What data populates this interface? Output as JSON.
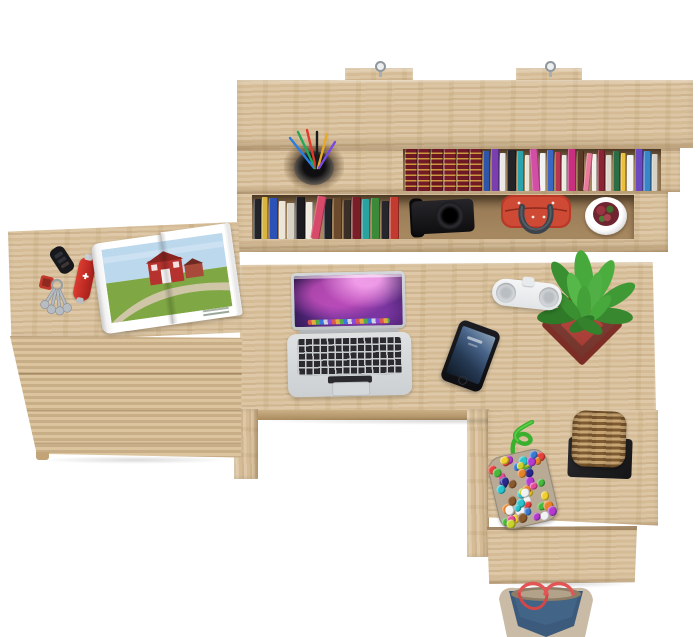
{
  "meta": {
    "description": "Top-down product photo of a light oak home-office set: wall hutch with books, L-shaped desk with laptop, phone, speaker and plant, three-drawer cabinet with keys, pocket knife and open magazine, desk return with bead pouch, wicker basket, drawer unit and a denim tote bag on the floor."
  },
  "palette": {
    "bg": "#ffffff",
    "wood": "#d8bf98",
    "woodLight": "#e3cda8",
    "woodDark": "#c3a478",
    "shelfBack": "#b1926a",
    "cordGreen": "#3ab02e",
    "bagRed": "#c5402f",
    "handleGray": "#3d434a",
    "basketTan": "#a87f4c",
    "denimBlue": "#3c5a7c",
    "denimTan": "#c9bba6",
    "strapRed": "#e25555",
    "plantGreen": "#3f9a35",
    "potRed": "#b5453c"
  },
  "shelf": {
    "upper_books": [
      {
        "c": "#6e1825",
        "w": 12,
        "h": 42,
        "g": 1
      },
      {
        "c": "#731a27",
        "w": 12,
        "h": 42,
        "g": 1
      },
      {
        "c": "#6a1622",
        "w": 12,
        "h": 42,
        "g": 1
      },
      {
        "c": "#771b28",
        "w": 12,
        "h": 42,
        "g": 1
      },
      {
        "c": "#6e1825",
        "w": 12,
        "h": 42,
        "g": 1
      },
      {
        "c": "#731a27",
        "w": 12,
        "h": 42,
        "g": 1
      },
      {
        "c": "#2e55aa",
        "w": 7,
        "h": 40
      },
      {
        "c": "#7a3fae",
        "w": 8,
        "h": 42
      },
      {
        "c": "#e9e9e9",
        "w": 6,
        "h": 38
      },
      {
        "c": "#23242a",
        "w": 9,
        "h": 41
      },
      {
        "c": "#2aa3ad",
        "w": 7,
        "h": 40
      },
      {
        "c": "#e8e4da",
        "w": 5,
        "h": 36
      },
      {
        "c": "#d34fa5",
        "w": 8,
        "h": 42,
        "l": -4
      },
      {
        "c": "#f2f2f2",
        "w": 6,
        "h": 38
      },
      {
        "c": "#3a66c4",
        "w": 7,
        "h": 41
      },
      {
        "c": "#b8374e",
        "w": 6,
        "h": 39
      },
      {
        "c": "#efeae0",
        "w": 5,
        "h": 36
      },
      {
        "c": "#c92f7f",
        "w": 8,
        "h": 42
      },
      {
        "c": "#5a3a28",
        "w": 7,
        "h": 40
      },
      {
        "c": "#e87a9a",
        "w": 6,
        "h": 38,
        "l": 6
      },
      {
        "c": "#f5f0e6",
        "w": 5,
        "h": 37
      },
      {
        "c": "#8a2433",
        "w": 7,
        "h": 41
      },
      {
        "c": "#ddd8cc",
        "w": 6,
        "h": 36
      },
      {
        "c": "#2a6e46",
        "w": 7,
        "h": 40
      },
      {
        "c": "#e8c23a",
        "w": 5,
        "h": 38
      },
      {
        "c": "#f4f4f4",
        "w": 7,
        "h": 36
      },
      {
        "c": "#6a49c0",
        "w": 8,
        "h": 42
      },
      {
        "c": "#3a85c8",
        "w": 7,
        "h": 40
      },
      {
        "c": "#d6d2c8",
        "w": 6,
        "h": 37
      }
    ],
    "lower_books": [
      {
        "c": "#23242a",
        "w": 7,
        "h": 40
      },
      {
        "c": "#d8b440",
        "w": 6,
        "h": 42
      },
      {
        "c": "#2a52b8",
        "w": 9,
        "h": 41
      },
      {
        "c": "#ece6da",
        "w": 7,
        "h": 38
      },
      {
        "c": "#d8d2c4",
        "w": 8,
        "h": 36
      },
      {
        "c": "#1c1c20",
        "w": 9,
        "h": 42
      },
      {
        "c": "#f0ece0",
        "w": 7,
        "h": 37
      },
      {
        "c": "#d84a6a",
        "w": 9,
        "h": 43,
        "l": 10
      },
      {
        "c": "#20222a",
        "w": 8,
        "h": 40
      },
      {
        "c": "#6b4a2e",
        "w": 9,
        "h": 41
      },
      {
        "c": "#3a2e26",
        "w": 8,
        "h": 39
      },
      {
        "c": "#7a1f28",
        "w": 9,
        "h": 42
      },
      {
        "c": "#2aa3a0",
        "w": 8,
        "h": 40
      },
      {
        "c": "#3a8a3a",
        "w": 9,
        "h": 41
      },
      {
        "c": "#26262c",
        "w": 8,
        "h": 38
      },
      {
        "c": "#c23b2e",
        "w": 9,
        "h": 42
      }
    ]
  },
  "beads": {
    "colors": [
      "#e8413c",
      "#f2cf2c",
      "#3a7ad4",
      "#47b83c",
      "#e8822a",
      "#b43ad0",
      "#2ac4cf",
      "#f2f2f2",
      "#e84a9a",
      "#8a5a2e",
      "#2a2a8e",
      "#c9d42a"
    ],
    "count": 56,
    "size": 7
  },
  "objects": {
    "hutch": "oak wall shelf with two metal hanging brackets",
    "pen_cup": "black cup holding coloured pens",
    "encyclopedia_set": "dark red hardcover set with gold bands",
    "camera": "black camera",
    "red_handbag": "red handbag with dark grey handles",
    "white_flowerpot": "white pot with burgundy plant",
    "laptop": "silver laptop, purple galaxy wallpaper, black keys",
    "speaker": "white pill-shaped portable speaker",
    "smartphone": "black smartphone with blue lock screen",
    "potted_plant": "green speckled plant in red square pot",
    "car_keys": "black car fob, red keychain and key bundle",
    "pocket_knife": "red pocket knife with white cross",
    "magazine": "open magazine spread showing a red barn in a green field",
    "drawer_cabinet": "oak cabinet with three drawers",
    "bead_pouch": "multicolour bead pouch with green cord",
    "wicker_basket": "woven rope basket on black square base",
    "return_drawer": "oak drawer unit under the desk return",
    "denim_bag": "blue denim tote with tan trim and red straps"
  }
}
